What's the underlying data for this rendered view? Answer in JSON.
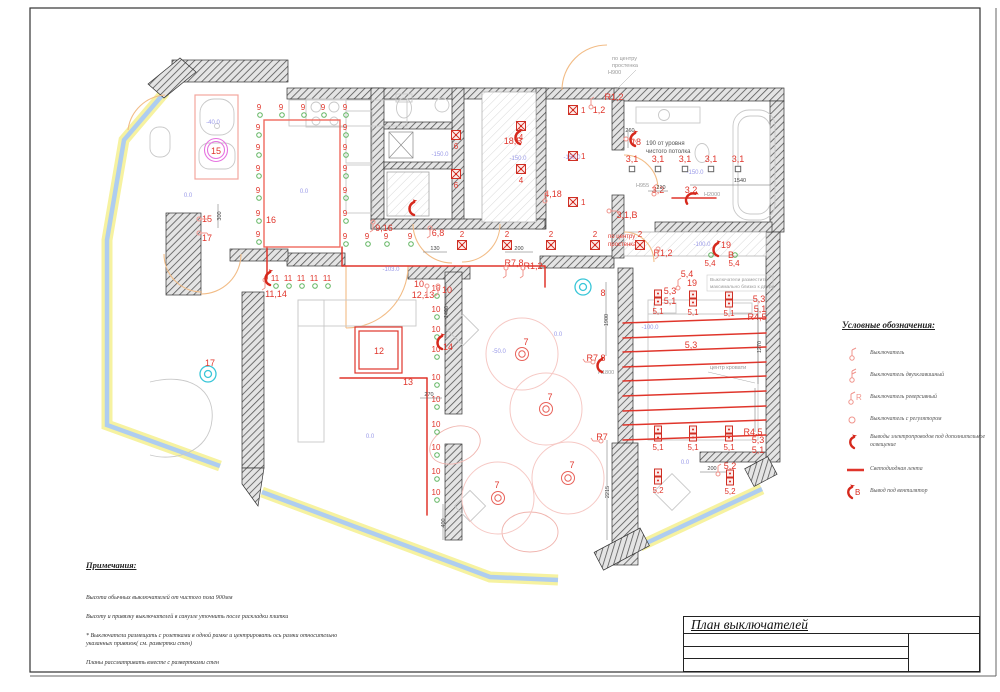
{
  "title_block": {
    "title": "План выключателей",
    "rows": [
      "",
      "",
      ""
    ]
  },
  "notes": {
    "heading": "Примечания:",
    "items": [
      "Высота обычных выключателей от чистого пола 900мм",
      "Высоту и привязку выключателей в санузле уточнить после раскладки плитки",
      "* Выключатели размещать с розетками в одной рамке и центрировать ось рамки относительно указанных привязок( см. развертки стен)",
      "Планы рассматривать вместе с развертками стен"
    ]
  },
  "legend": {
    "heading": "Условные обозначения:",
    "items": [
      {
        "icon": "switch-single",
        "label": "Выключатель"
      },
      {
        "icon": "switch-double",
        "label": "Выключатель двухклавишный"
      },
      {
        "icon": "switch-reverse",
        "label": "Выключатель реверсивный"
      },
      {
        "icon": "switch-dimmer",
        "label": "Выключатель с регулятором"
      },
      {
        "icon": "wire-output",
        "label": "Выводы электропроводов под дополнительное освещение"
      },
      {
        "icon": "led-strip",
        "label": "Светодиодная лента"
      },
      {
        "icon": "fan-output",
        "label": "Вывод под вентилятор"
      }
    ]
  },
  "colors": {
    "marker_red": "#e0352b",
    "pink": "#f0948c",
    "green": "#62b562",
    "elevation_blue": "#9a9ae8",
    "window_blue": "#aecdf0",
    "window_yellow": "#f6f2a0",
    "door_orange": "#f2bc86",
    "cyan": "#39c6d8",
    "magenta": "#e673e0"
  },
  "plan": {
    "downlights": [
      {
        "label": "9",
        "points": [
          [
            259,
            110
          ],
          [
            281,
            110
          ],
          [
            303,
            110
          ],
          [
            323,
            110
          ],
          [
            345,
            110
          ],
          [
            258,
            130
          ],
          [
            258,
            150
          ],
          [
            258,
            171
          ],
          [
            258,
            193
          ],
          [
            258,
            216
          ],
          [
            258,
            237
          ],
          [
            345,
            130
          ],
          [
            345,
            150
          ],
          [
            345,
            171
          ],
          [
            345,
            193
          ],
          [
            345,
            216
          ],
          [
            345,
            239
          ],
          [
            367,
            239
          ],
          [
            386,
            239
          ],
          [
            410,
            239
          ]
        ]
      },
      {
        "label": "10",
        "points": [
          [
            436,
            291
          ],
          [
            436,
            312
          ],
          [
            436,
            332
          ],
          [
            436,
            352
          ],
          [
            436,
            380
          ],
          [
            436,
            402
          ],
          [
            436,
            427
          ],
          [
            436,
            450
          ],
          [
            436,
            474
          ],
          [
            436,
            495
          ]
        ]
      },
      {
        "label": "11",
        "points": [
          [
            275,
            281
          ],
          [
            288,
            281
          ],
          [
            301,
            281
          ],
          [
            314,
            281
          ],
          [
            327,
            281
          ]
        ]
      },
      {
        "label": "5,4",
        "circle_dy": -11,
        "points": [
          [
            710,
            266
          ],
          [
            734,
            266
          ]
        ]
      }
    ],
    "spots": [
      {
        "label": "1",
        "lpos": "right",
        "points": [
          [
            573,
            110
          ],
          [
            573,
            156
          ],
          [
            573,
            202
          ]
        ]
      },
      {
        "label": "2",
        "lpos": "above",
        "points": [
          [
            462,
            245
          ],
          [
            507,
            245
          ],
          [
            551,
            245
          ],
          [
            595,
            245
          ],
          [
            640,
            245
          ]
        ]
      },
      {
        "label": "4",
        "lpos": "below",
        "points": [
          [
            521,
            126
          ],
          [
            521,
            169
          ]
        ]
      },
      {
        "label": "6",
        "lpos": "below",
        "points": [
          [
            456,
            135
          ],
          [
            456,
            174
          ]
        ]
      }
    ],
    "squares31": {
      "label": "3,1",
      "points": [
        [
          632,
          169
        ],
        [
          658,
          169
        ],
        [
          685,
          169
        ],
        [
          711,
          169
        ],
        [
          738,
          169
        ]
      ]
    },
    "pendants": {
      "label": "7",
      "points": [
        [
          522,
          354
        ],
        [
          546,
          409
        ],
        [
          568,
          478
        ],
        [
          498,
          498
        ]
      ]
    },
    "wall_lights": [
      {
        "label": "5,1",
        "points": [
          [
            658,
            298
          ],
          [
            693,
            299
          ],
          [
            729,
            300
          ],
          [
            658,
            434
          ],
          [
            693,
            434
          ],
          [
            729,
            434
          ]
        ]
      },
      {
        "label": "5,2",
        "points": [
          [
            658,
            477
          ],
          [
            730,
            478
          ]
        ]
      }
    ],
    "special_circles": [
      {
        "kind": "magenta",
        "x": 216,
        "y": 150
      },
      {
        "kind": "cyan",
        "x": 208,
        "y": 374
      },
      {
        "kind": "cyan",
        "x": 583,
        "y": 287
      }
    ],
    "led_lines": [
      [
        623,
        323,
        766,
        318
      ],
      [
        623,
        338,
        766,
        333
      ],
      [
        623,
        352,
        766,
        347
      ],
      [
        623,
        367,
        766,
        362
      ],
      [
        623,
        381,
        766,
        376
      ],
      [
        623,
        396,
        766,
        391
      ],
      [
        623,
        411,
        766,
        406
      ],
      [
        623,
        425,
        766,
        420
      ],
      [
        623,
        440,
        766,
        435
      ],
      [
        672,
        198,
        716,
        198
      ],
      [
        427,
        378,
        427,
        515
      ],
      [
        340,
        378,
        427,
        378
      ],
      [
        342,
        247,
        342,
        266
      ],
      [
        267,
        247,
        267,
        279
      ],
      [
        342,
        266,
        545,
        266
      ],
      [
        545,
        266,
        545,
        287
      ]
    ],
    "red_rects": [
      {
        "x": 264,
        "y": 120,
        "w": 76,
        "h": 127,
        "cls": "led-rect",
        "double": false
      },
      {
        "x": 355,
        "y": 327,
        "w": 47,
        "h": 46,
        "cls": "led-rect2",
        "double": true
      },
      {
        "x": 195,
        "y": 95,
        "w": 43,
        "h": 84,
        "cls": "pink-rect",
        "double": false
      }
    ],
    "group_labels": [
      [
        "15",
        207,
        222
      ],
      [
        "17",
        207,
        241
      ],
      [
        "9,16",
        384,
        231
      ],
      [
        "6,8",
        438,
        236
      ],
      [
        "11,14",
        276,
        297
      ],
      [
        "10",
        419,
        287
      ],
      [
        "12,13",
        423,
        298
      ],
      [
        "10",
        447,
        293
      ],
      [
        "14",
        448,
        350
      ],
      [
        "R7,8",
        514,
        266
      ],
      [
        "R1,2",
        533,
        269
      ],
      [
        "1,2",
        599,
        113
      ],
      [
        "R1,2",
        614,
        100
      ],
      [
        "4,18",
        553,
        197
      ],
      [
        "18,В",
        513,
        144
      ],
      [
        "3,1,В",
        627,
        218
      ],
      [
        "3,2",
        658,
        193
      ],
      [
        "3,2",
        691,
        193
      ],
      [
        "18",
        636,
        145
      ],
      [
        "19",
        726,
        248
      ],
      [
        "В",
        731,
        258
      ],
      [
        "R1,2",
        663,
        256
      ],
      [
        "5,4",
        687,
        277
      ],
      [
        "19",
        692,
        286
      ],
      [
        "5,3",
        670,
        294
      ],
      [
        "5,1",
        670,
        304
      ],
      [
        "5,3",
        759,
        302
      ],
      [
        "5,1",
        760,
        312
      ],
      [
        "R4,5",
        757,
        320
      ],
      [
        "R4,5",
        753,
        435
      ],
      [
        "5,3",
        758,
        443
      ],
      [
        "5,1",
        758,
        453
      ],
      [
        "5,2",
        730,
        469
      ],
      [
        "R7,8",
        596,
        361
      ],
      [
        "8",
        603,
        296
      ],
      [
        "R7",
        602,
        440
      ],
      [
        "13",
        408,
        385
      ],
      [
        "16",
        271,
        223
      ],
      [
        "12",
        379,
        354
      ],
      [
        "5,3",
        691,
        348
      ],
      [
        "15",
        216,
        154
      ],
      [
        "17",
        210,
        366
      ],
      [
        "7",
        526,
        345
      ],
      [
        "7",
        550,
        400
      ],
      [
        "7",
        572,
        468
      ],
      [
        "7",
        497,
        488
      ]
    ],
    "elevations": [
      [
        "-40.0",
        213,
        124
      ],
      [
        "0.0",
        304,
        193
      ],
      [
        "0.0",
        188,
        197
      ],
      [
        "-150.0",
        440,
        156
      ],
      [
        "-150.0",
        518,
        160
      ],
      [
        "-150.0",
        572,
        159
      ],
      [
        "-103.0",
        391,
        271
      ],
      [
        "-150.0",
        695,
        174
      ],
      [
        "-100.0",
        702,
        246
      ],
      [
        "-100.0",
        650,
        329
      ],
      [
        "-50.0",
        499,
        353
      ],
      [
        "0.0",
        558,
        336
      ],
      [
        "0.0",
        370,
        438
      ],
      [
        "0.0",
        685,
        464
      ]
    ],
    "dims": [
      [
        "1540",
        740,
        182,
        0
      ],
      [
        "210",
        661,
        189,
        0
      ],
      [
        "130",
        435,
        250,
        0
      ],
      [
        "200",
        519,
        250,
        0
      ],
      [
        "270",
        429,
        396,
        0
      ],
      [
        "200",
        712,
        470,
        0
      ],
      [
        "300",
        221,
        216,
        -90
      ],
      [
        "1270",
        761,
        347,
        -90
      ],
      [
        "2215",
        609,
        492,
        -90
      ],
      [
        "1900",
        608,
        320,
        -90
      ],
      [
        "1400",
        448,
        312,
        -90
      ],
      [
        "400",
        445,
        523,
        -90
      ],
      [
        "260",
        630,
        132,
        0
      ]
    ],
    "annotations": [
      [
        "по центру",
        612,
        60,
        "ann-gray"
      ],
      [
        "простенка",
        612,
        67,
        "ann-gray"
      ],
      [
        "Н900",
        608,
        74,
        "ann-gray"
      ],
      [
        "190 от уровня",
        646,
        145,
        "ann-dark"
      ],
      [
        "чистого потолка",
        646,
        153,
        "ann-dark"
      ],
      [
        "по центру",
        608,
        238,
        "ann-red"
      ],
      [
        "простенка",
        608,
        246,
        "ann-red"
      ],
      [
        "Выключатели разместить",
        710,
        281,
        "ann-gray6"
      ],
      [
        "максимально близко к двери",
        710,
        288,
        "ann-gray6"
      ],
      [
        "центр кровати",
        710,
        369,
        "ann-gray"
      ],
      [
        "H2000",
        704,
        196,
        "ann-gray"
      ],
      [
        "H1800",
        598,
        374,
        "ann-gray"
      ],
      [
        "Н955",
        636,
        187,
        "ann-gray"
      ]
    ],
    "switches": [
      [
        202,
        219,
        90
      ],
      [
        202,
        233,
        90
      ],
      [
        427,
        289,
        180
      ],
      [
        438,
        289,
        180
      ],
      [
        506,
        271,
        180
      ],
      [
        523,
        271,
        180
      ],
      [
        612,
        211,
        90
      ],
      [
        658,
        252,
        180
      ],
      [
        678,
        285,
        0
      ],
      [
        265,
        283,
        180
      ],
      [
        373,
        225,
        180
      ],
      [
        430,
        231,
        180
      ],
      [
        629,
        139,
        90
      ],
      [
        545,
        198,
        0
      ],
      [
        590,
        362,
        270
      ],
      [
        598,
        441,
        270
      ],
      [
        591,
        104,
        0
      ],
      [
        718,
        471,
        0
      ],
      [
        654,
        191,
        0
      ]
    ],
    "arrows": [
      [
        268,
        278,
        0
      ],
      [
        440,
        342,
        0
      ],
      [
        412,
        208,
        0
      ],
      [
        518,
        137,
        0
      ],
      [
        633,
        139,
        0
      ],
      [
        690,
        197,
        40
      ],
      [
        716,
        249,
        0
      ],
      [
        600,
        365,
        0
      ]
    ],
    "dim_lines": [
      [
        690,
        185,
        770,
        185
      ],
      [
        648,
        191,
        668,
        191
      ],
      [
        420,
        398,
        442,
        398
      ],
      [
        505,
        252,
        533,
        252
      ],
      [
        423,
        252,
        447,
        252
      ],
      [
        218,
        204,
        218,
        228
      ],
      [
        758,
        308,
        758,
        384
      ],
      [
        606,
        282,
        606,
        356
      ],
      [
        607,
        440,
        607,
        540
      ],
      [
        446,
        284,
        446,
        338
      ],
      [
        443,
        504,
        443,
        540
      ],
      [
        700,
        472,
        726,
        472
      ],
      [
        628,
        130,
        628,
        148
      ],
      [
        755,
        388,
        755,
        432
      ]
    ]
  }
}
